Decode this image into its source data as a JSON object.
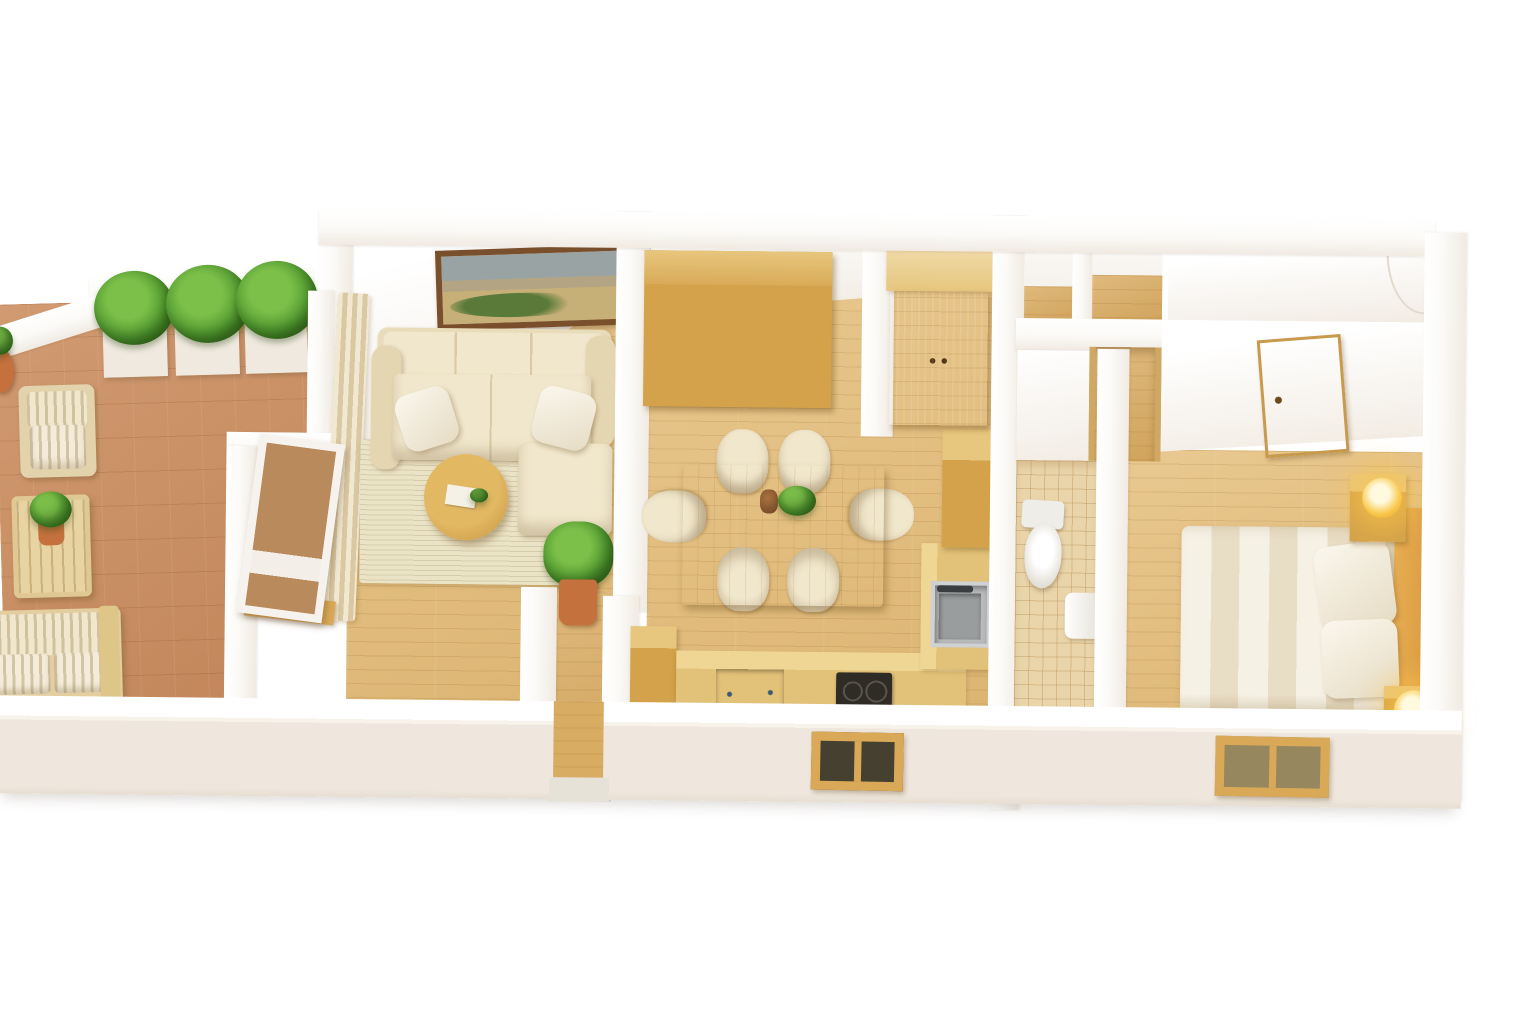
{
  "scene": {
    "type": "3d-floor-plan-render",
    "view": "isometric top-down dollhouse cutaway",
    "background": "#ffffff",
    "visible_text": "none"
  },
  "palette": {
    "wall": "#fbfaf7",
    "wallFace": "#f0eae2",
    "wallOuter": "#efe7dd",
    "woodFloor": "#e5bf7c",
    "woodFloorDeep": "#d9ac64",
    "plankLine": "rgba(146,96,30,0.17)",
    "terracotta": "#cc8f62",
    "terracottaLine": "rgba(120,62,22,0.16)",
    "oak": "#d3a24a",
    "oakDark": "#c08b3a",
    "oakLight": "#e7c67e",
    "sofaBeige": "#e9dcba",
    "cushion": "#f1e7cc",
    "rug": "#ebe3c6",
    "green": "#55a032",
    "greenLight": "#7cc04a",
    "greenDark": "#2f5e16",
    "steel": "#b9bbbc",
    "steelDeep": "#9a9d9e",
    "cooktop": "#2f2c25",
    "dishwasher": "#8fb3cd",
    "tileBath": "#ead5ab",
    "tileLine": "rgba(190,150,90,0.45)",
    "lampCore": "#f8c84a",
    "lampGlow": "rgba(255,198,74,0.6)",
    "pictureFrame": "#7a4f2c",
    "entryMat": "#e7e2d8",
    "glassDoor": "#b98a5c",
    "winFrame": "#d9a958",
    "paneDark": "#45402f",
    "paneLight": "#97875f",
    "bedding": "#f6f1e5",
    "beddingShade": "#e8ddc5",
    "bedWood": "#d9993f",
    "potClay": "#c4713e"
  },
  "rooms": [
    {
      "id": "terrace",
      "floor": "terracotta-tile",
      "furniture": [
        "planter-box-1",
        "planter-box-2",
        "planter-box-3",
        "shrubs",
        "corner-pot-plant",
        "outdoor-armchair",
        "outdoor-coffee-table",
        "table-plant",
        "outdoor-sofa"
      ]
    },
    {
      "id": "living-room",
      "floor": "light-wood-plank",
      "furniture": [
        "framed-landscape-picture",
        "curtains",
        "sectional-sofa",
        "sofa-pillows",
        "round-coffee-table",
        "book-on-table",
        "area-rug",
        "potted-plant",
        "terrace-glass-door"
      ]
    },
    {
      "id": "entry-corridor",
      "floor": "light-wood-plank",
      "furniture": [
        "entry-mat"
      ]
    },
    {
      "id": "dining-kitchen",
      "floor": "light-wood-plank",
      "furniture": [
        "shelving-unit-15-cubbies-5-doors",
        "dining-table",
        "table-vase",
        "table-plant",
        "chair-x6",
        "kitchen-island",
        "kitchen-counter",
        "induction-cooktop-2-burner",
        "dishwasher",
        "sink-counter",
        "steel-sink",
        "tall-cabinet",
        "double-door-wardrobe",
        "exterior-window"
      ]
    },
    {
      "id": "bathroom",
      "floor": "beige-tile",
      "furniture": [
        "toilet",
        "wall-fixture"
      ]
    },
    {
      "id": "hallway",
      "floor": "light-wood-plank",
      "furniture": [
        "storage-niche-1",
        "storage-niche-2",
        "open-doorway"
      ]
    },
    {
      "id": "bedroom",
      "floor": "light-wood-plank",
      "furniture": [
        "closet-niche",
        "wooden-entry-door",
        "double-bed",
        "headboard",
        "pillow-x2",
        "nightstand-top",
        "nightstand-bottom",
        "glowing-lamp-x2",
        "exterior-window"
      ]
    }
  ]
}
